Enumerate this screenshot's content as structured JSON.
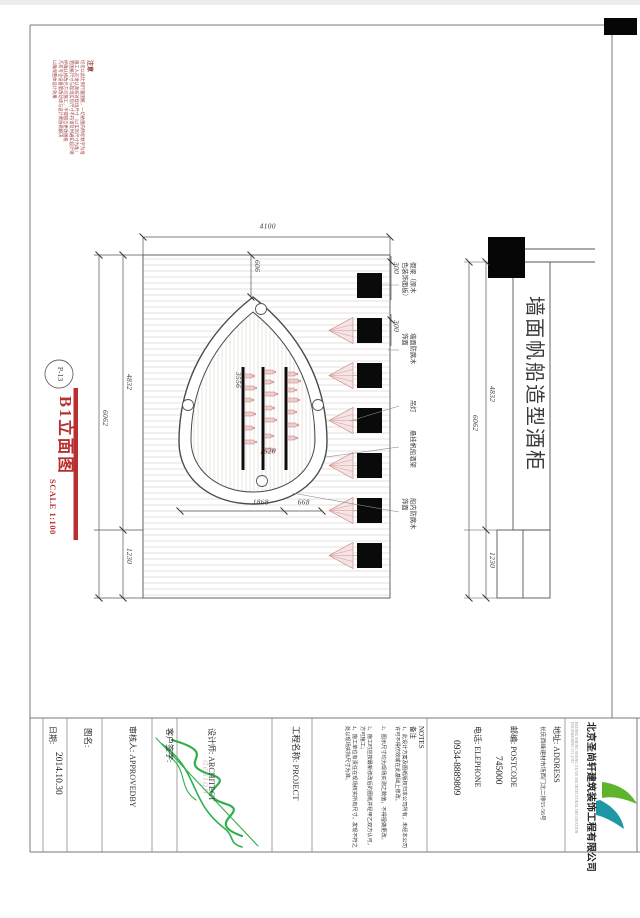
{
  "notice": {
    "title": "注意",
    "lines": [
      "切勿以此比例尺量图纸，一切依图内所标数字为准",
      "施工人员请认真核对现场尺寸（以实际尺寸为准）",
      "若图纸尺寸与现场实际尺寸不符请及时通知设计师",
      "经确认修改后方可施工，不得擅自更改图纸",
      "凡有专业设备需改动请与设计师协商解决",
      "以确保整体设计效果"
    ]
  },
  "drawing_label": {
    "ref": "P-13",
    "title": "B1立面图",
    "scale": "SCALE 1:100"
  },
  "dims": {
    "d4100": "4100",
    "d606": "606",
    "d300": "300",
    "d3556": "3556",
    "d1626": "1626",
    "d1868": "1868",
    "d668": "668",
    "d4832": "4832",
    "d1230": "1230",
    "d6062": "6062"
  },
  "elevation": {
    "beam_count": 7,
    "lamp_count": 6,
    "shelf_count": 3,
    "callouts": [
      {
        "l1": "假梁（原木",
        "l2": "色装饰面板）"
      },
      {
        "l1": "墙面防腐木",
        "l2": "饰面"
      },
      {
        "l1": "吊灯",
        "l2": ""
      },
      {
        "l1": "悬挂帆船酒架",
        "l2": ""
      },
      {
        "l1": "船内防腐木",
        "l2": "饰面"
      }
    ]
  },
  "section": {
    "title": "墙面帆船造型酒柜"
  },
  "titleblock": {
    "date_label": "日期:",
    "date_value": "2014.10.30",
    "sheet_label": "图名:",
    "approver_label": "审核人: APPROVEDBY",
    "client_label": "客户签字:",
    "architect_label": "设计师: ARCHITECT",
    "watermark": "design",
    "project_label": "工程名称:  PROJECT",
    "notes_title_en": "NOTES",
    "notes_title_cn": "备注",
    "notes_items": [
      "1、此设计方案及图纸版权归本公司所有，未经本公司许可不得仿效或在此基础上修改。",
      "2、图示尺寸均为现场实测之数值，不得擅做更改。",
      "3、施工时应按最新修改后的图纸并经甲乙双方认可，方可施工；",
      "4、施工单位有责任在现场核实所有尺寸，发现不符之处以现场实际尺寸为准。"
    ],
    "address_label": "地址:  ADDRESS",
    "address_value": "长庆西峰建材市场西门北二排55-56号",
    "postcode_label": "邮编:  POSTCODE",
    "postcode_value": "745000",
    "phone_label": "电话:  ELEPHONE",
    "phone_value": "0934-8889809",
    "company_name": "北京圣尚轩建筑装饰工程有限公司",
    "company_en": "BEIJING SHENG SHANG XUAN ARCHITECTURAL DECORATION ENGINEERING CO.,LTD"
  },
  "colors": {
    "accent_red": "#b93030",
    "note_red": "#9a3a3a",
    "signature_green": "#2fae4e",
    "logo_green": "#5fb32d",
    "logo_teal": "#1e98a4",
    "lamp_pink": "#cf9393",
    "bottle_pink": "#c47b7b"
  }
}
